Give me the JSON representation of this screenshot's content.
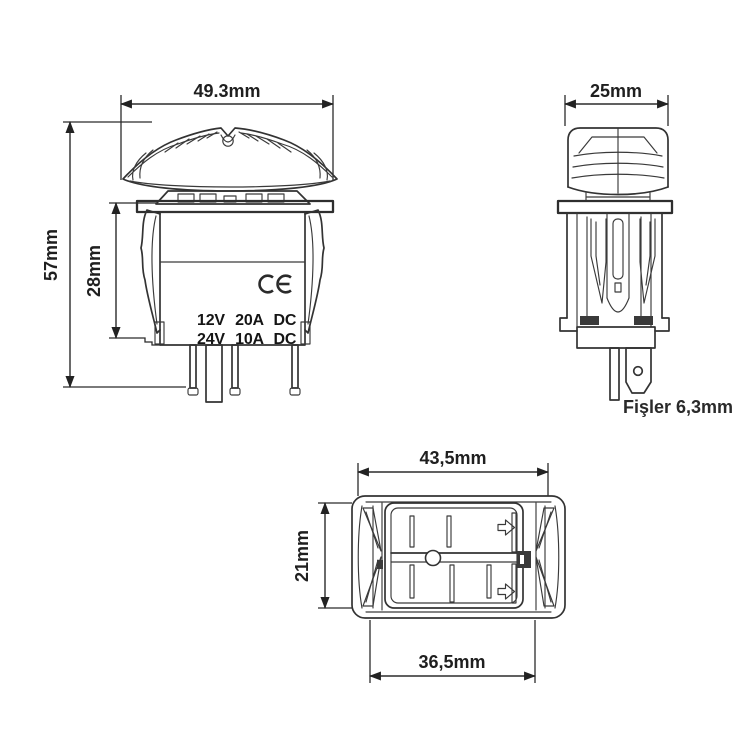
{
  "page": {
    "background": "#ffffff"
  },
  "drawing": {
    "type": "technical-diagram",
    "subject": "panel rocker switch dimension drawing",
    "line_color": "#333333",
    "text_color": "#1f1f1f",
    "views": {
      "front": {
        "name": "front-view",
        "dim_width": "49.3mm",
        "dim_total_height": "57mm",
        "dim_body_height": "28mm",
        "rating_line1": "12V 20A DC",
        "rating_line2": "24V 10A DC",
        "ce_mark": "CE"
      },
      "side": {
        "name": "side-view",
        "dim_width": "25mm",
        "terminal_note": "Fişler 6,3mm"
      },
      "bottom": {
        "name": "bottom-view",
        "dim_outer_width": "43,5mm",
        "dim_height": "21mm",
        "dim_inner_width": "36,5mm"
      }
    }
  }
}
